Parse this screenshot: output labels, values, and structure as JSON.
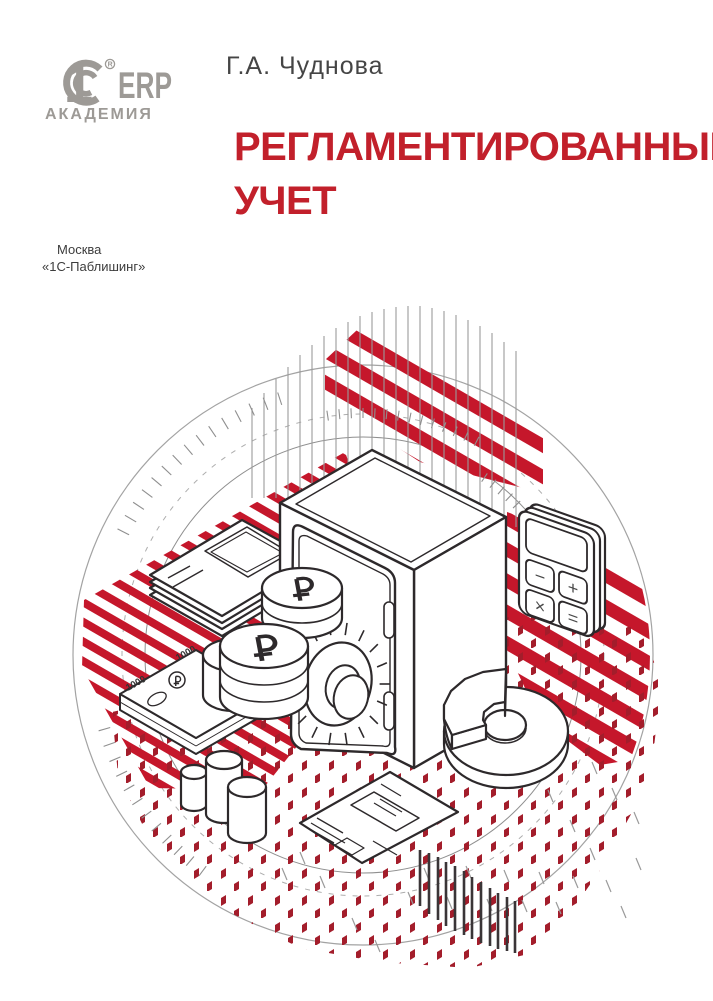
{
  "brand": {
    "one": "1",
    "erp": "ERP",
    "academy": "АКАДЕМИЯ",
    "reg_mark": "R",
    "color": "#9d9a96"
  },
  "author": {
    "name": "Г.А. Чуднова"
  },
  "title": {
    "line1": "РЕГЛАМЕНТИРОВАННЫЙ",
    "line2": "УЧЕТ",
    "color": "#c2202b"
  },
  "publisher": {
    "city": "Москва",
    "name": "«1С-Паблишинг»"
  },
  "illustration": {
    "colors": {
      "stripe_red": "#c5172b",
      "dot_red": "#a31d2b",
      "outline": "#2d292b",
      "line_gray": "#9a9a9a",
      "bar_dark": "#3a3537"
    },
    "bundle_label": "1000",
    "calc_keys": {
      "minus": "−",
      "plus": "+",
      "multiply": "×",
      "equals": "="
    },
    "top_bars": [
      [
        252,
        408,
        498
      ],
      [
        264,
        393,
        498
      ],
      [
        276,
        379,
        498
      ],
      [
        288,
        367,
        498
      ],
      [
        300,
        355,
        500
      ],
      [
        312,
        345,
        500
      ],
      [
        324,
        336,
        500
      ],
      [
        336,
        328,
        500
      ],
      [
        348,
        322,
        505
      ],
      [
        360,
        316,
        505
      ],
      [
        372,
        312,
        505
      ],
      [
        384,
        309,
        462
      ],
      [
        396,
        307,
        468
      ],
      [
        408,
        306,
        474
      ],
      [
        420,
        306,
        480
      ],
      [
        432,
        308,
        486
      ],
      [
        444,
        311,
        492
      ],
      [
        456,
        315,
        498
      ],
      [
        468,
        320,
        504
      ],
      [
        480,
        326,
        510
      ],
      [
        492,
        333,
        516
      ],
      [
        504,
        342,
        521
      ],
      [
        516,
        351,
        527
      ]
    ],
    "bottom_bars": [
      [
        420,
        850,
        906
      ],
      [
        429,
        853,
        914
      ],
      [
        438,
        857,
        920
      ],
      [
        446,
        862,
        926
      ],
      [
        455,
        866,
        931
      ],
      [
        464,
        871,
        935
      ],
      [
        472,
        877,
        939
      ],
      [
        481,
        882,
        943
      ],
      [
        490,
        888,
        946
      ],
      [
        498,
        893,
        949
      ],
      [
        507,
        897,
        951
      ],
      [
        515,
        901,
        953
      ]
    ],
    "tick_arcs": [
      {
        "r": 263,
        "a1": 108,
        "a2": 155,
        "step": 3.2,
        "len": 13
      },
      {
        "r": 237,
        "a1": 62,
        "a2": 100,
        "step": 2.8,
        "len": 10
      },
      {
        "r": 210,
        "a1": 22,
        "a2": 58,
        "step": 2.8,
        "len": 10
      },
      {
        "r": 263,
        "a1": 196,
        "a2": 234,
        "step": 3.4,
        "len": 12
      }
    ],
    "scatter_dashes": [
      [
        408,
        892
      ],
      [
        424,
        868
      ],
      [
        447,
        897
      ],
      [
        466,
        866
      ],
      [
        487,
        899
      ],
      [
        504,
        870
      ],
      [
        522,
        900
      ],
      [
        539,
        872
      ],
      [
        556,
        902
      ],
      [
        573,
        876
      ],
      [
        590,
        848
      ],
      [
        606,
        880
      ],
      [
        621,
        906
      ],
      [
        636,
        858
      ],
      [
        300,
        852
      ],
      [
        320,
        876
      ],
      [
        282,
        868
      ],
      [
        352,
        918
      ],
      [
        375,
        940
      ],
      [
        592,
        762
      ],
      [
        612,
        788
      ],
      [
        634,
        812
      ],
      [
        570,
        820
      ],
      [
        548,
        790
      ]
    ],
    "dial": {
      "cx": 338,
      "cy": 684,
      "rx": 52,
      "ry": 62,
      "n": 18
    }
  }
}
